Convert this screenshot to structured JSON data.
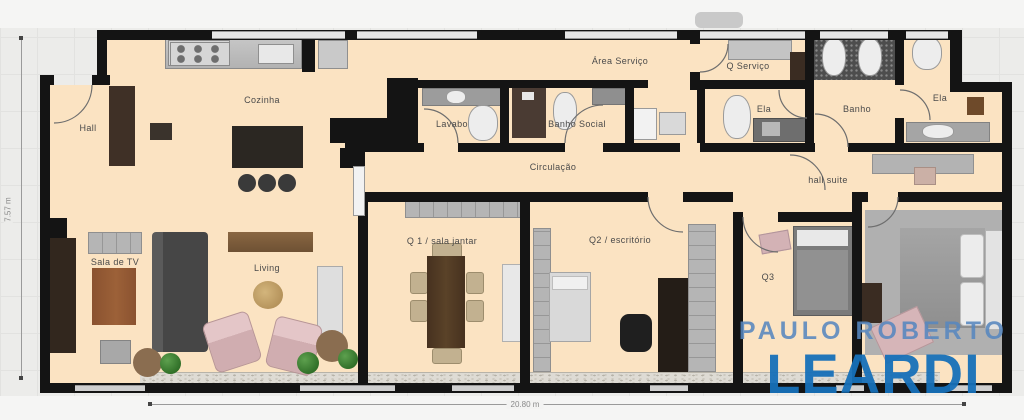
{
  "rooms": {
    "hall": "Hall",
    "cozinha": "Cozinha",
    "area_servico": "Área Serviço",
    "q_servico": "Q Serviço",
    "lavabo": "Lavabo",
    "banho_social": "Banho Social",
    "circulacao": "Circulação",
    "ela_1": "Ela",
    "banho": "Banho",
    "ela_2": "Ela",
    "hall_suite": "hall suite",
    "sala_tv": "Sala de TV",
    "living": "Living",
    "q1": "Q 1 / sala jantar",
    "q2": "Q2 / escritório",
    "q3": "Q3"
  },
  "dimensions": {
    "width": "20.80 m",
    "height": "7.57 m"
  },
  "watermark": {
    "line1": "PAULO ROBERTO",
    "line2": "LEARDI",
    "color_line1": "#5786be",
    "color_line2": "#1670b8"
  },
  "colors": {
    "floor": "#fbe3c2",
    "wall": "#141414",
    "background": "#ececea"
  }
}
